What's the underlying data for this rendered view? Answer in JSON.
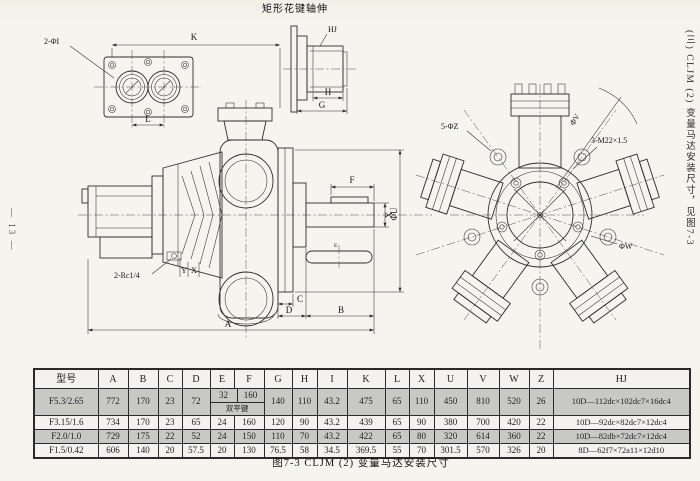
{
  "page": {
    "page_number": "— 13 —",
    "sidebar_text": "(三) CLJM (2) 变量马达安装尺寸，见图7-3"
  },
  "drawing": {
    "spline_view_title": "矩形花键轴伸",
    "labels": {
      "two_ports": "2-ΦI",
      "k": "K",
      "l": "L",
      "spline_hj": "HJ",
      "h": "H",
      "g": "G",
      "f": "F",
      "x_shaft": "X",
      "phi_u": "ΦU",
      "e_key": "E",
      "drain": "2-Rc1/4",
      "y_drain": "Y",
      "x_drain": "X",
      "c": "C",
      "d": "D",
      "b": "B",
      "a": "A",
      "five_holes": "5-ΦZ",
      "three_threads": "3-M22×1.5",
      "phi_v": "ΦV",
      "phi_w": "ΦW"
    }
  },
  "table": {
    "headers": [
      "型号",
      "A",
      "B",
      "C",
      "D",
      "E",
      "F",
      "G",
      "H",
      "I",
      "K",
      "L",
      "X",
      "U",
      "V",
      "W",
      "Z",
      "HJ"
    ],
    "rows": [
      [
        "F5.3/2.65",
        "772",
        "170",
        "23",
        "72",
        {
          "e": "32",
          "f": "160",
          "note": "双平键"
        },
        "140",
        "110",
        "43.2",
        "475",
        "65",
        "110",
        "450",
        "810",
        "520",
        "26",
        "10D—112dc×102dc7×16dc4"
      ],
      [
        "F3.15/1.6",
        "734",
        "170",
        "23",
        "65",
        "24",
        "160",
        "120",
        "90",
        "43.2",
        "439",
        "65",
        "90",
        "380",
        "700",
        "420",
        "22",
        "10D—92dc×82dc7×12dc4"
      ],
      [
        "F2.0/1.0",
        "729",
        "175",
        "22",
        "52",
        "24",
        "150",
        "110",
        "70",
        "43.2",
        "422",
        "65",
        "80",
        "320",
        "614",
        "360",
        "22",
        "10D—82db×72dc7×12dc4"
      ],
      [
        "F1.5/0.42",
        "606",
        "140",
        "20",
        "57.5",
        "20",
        "130",
        "76.5",
        "58",
        "34.5",
        "369.5",
        "55",
        "70",
        "301.5",
        "570",
        "326",
        "20",
        "8D—62f7×72a11×12d10"
      ]
    ]
  },
  "caption": "图7-3 CLJM (2) 变量马达安装尺寸"
}
